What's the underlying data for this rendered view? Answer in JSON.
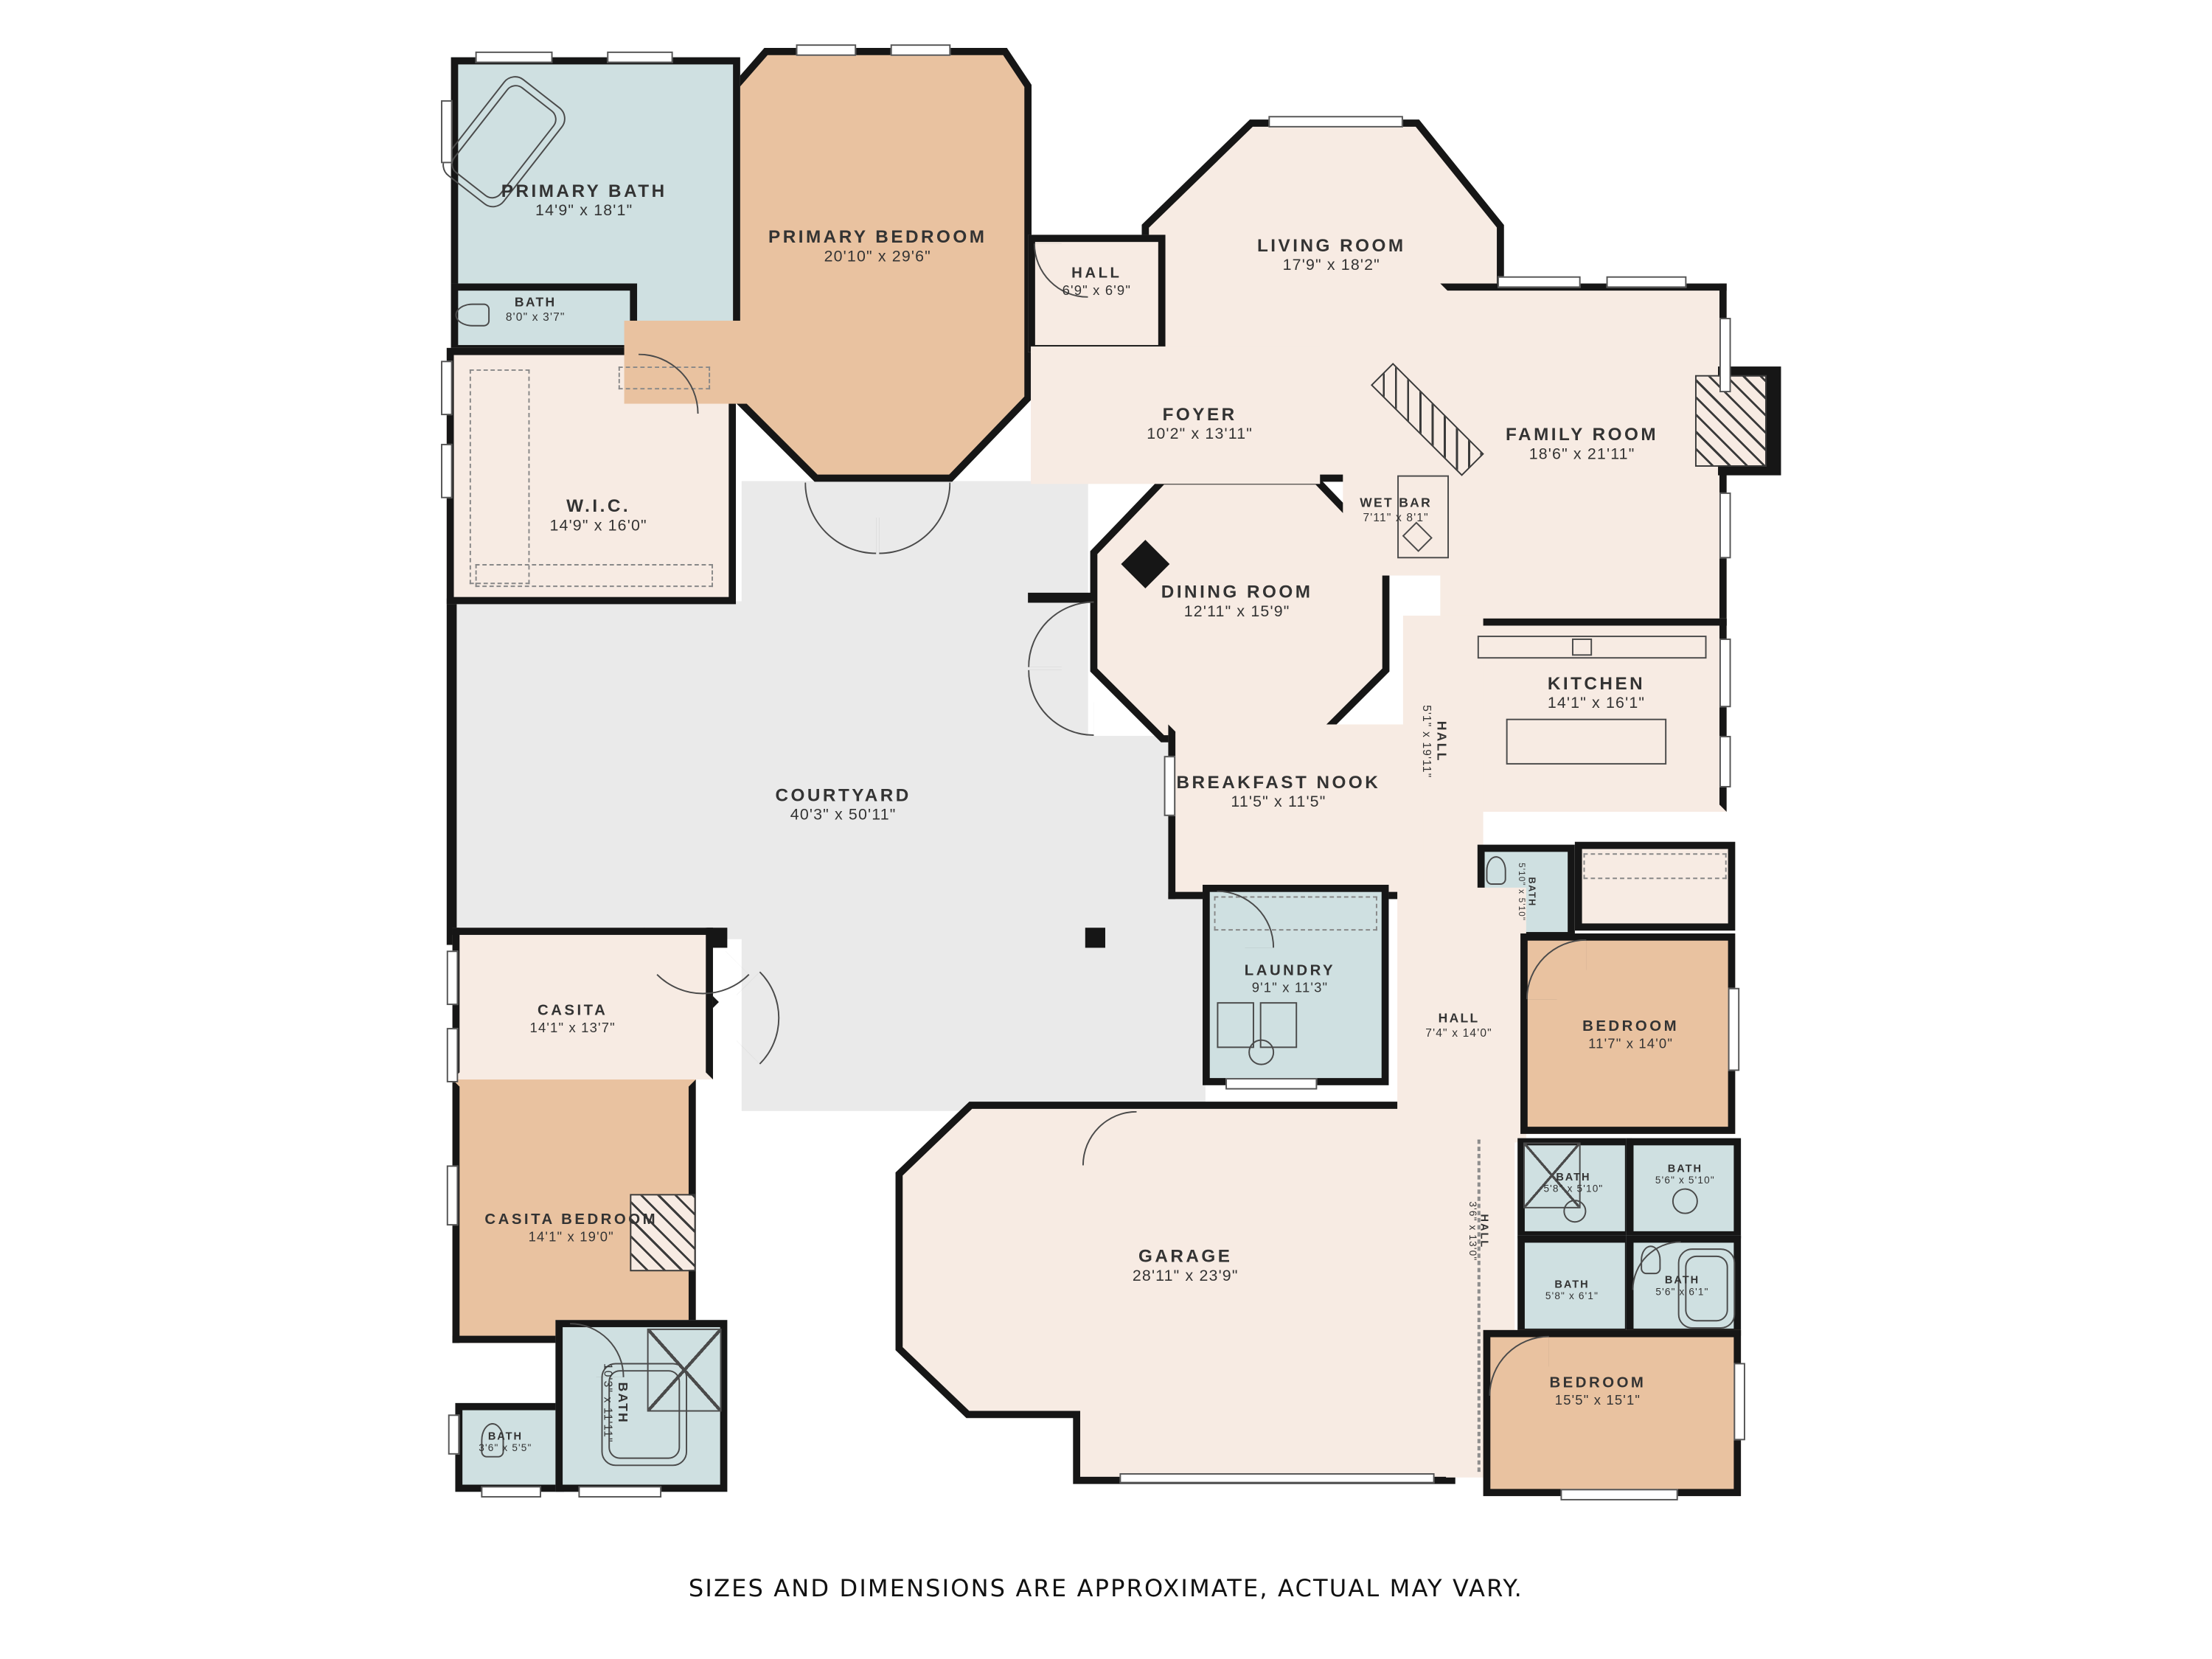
{
  "page": {
    "background": "#ffffff"
  },
  "palette": {
    "wall": "#161616",
    "bedroom_fill": "#e9c2a0",
    "bath_fill": "#cfe0e1",
    "living_fill": "#f7ebe3",
    "courtyard_fill": "#eaeaea",
    "window": "#ffffff",
    "text": "#333333"
  },
  "rooms": [
    {
      "name": "PRIMARY BATH",
      "dims": "14'9\" x 18'1\"",
      "fill": "bath"
    },
    {
      "name": "BATH",
      "dims": "8'0\" x 3'7\"",
      "fill": "bath"
    },
    {
      "name": "W.I.C.",
      "dims": "14'9\" x 16'0\"",
      "fill": "living"
    },
    {
      "name": "PRIMARY BEDROOM",
      "dims": "20'10\" x 29'6\"",
      "fill": "bedroom"
    },
    {
      "name": "HALL",
      "dims": "6'9\" x 6'9\"",
      "fill": "living"
    },
    {
      "name": "LIVING ROOM",
      "dims": "17'9\" x 18'2\"",
      "fill": "living"
    },
    {
      "name": "FOYER",
      "dims": "10'2\" x 13'11\"",
      "fill": "living"
    },
    {
      "name": "FAMILY ROOM",
      "dims": "18'6\" x 21'11\"",
      "fill": "living"
    },
    {
      "name": "WET BAR",
      "dims": "7'11\" x 8'1\"",
      "fill": "living"
    },
    {
      "name": "DINING ROOM",
      "dims": "12'11\" x 15'9\"",
      "fill": "living"
    },
    {
      "name": "KITCHEN",
      "dims": "14'1\" x 16'1\"",
      "fill": "living"
    },
    {
      "name": "HALL",
      "dims": "5'1\" x 19'11\"",
      "fill": "living",
      "orientation": "vertical"
    },
    {
      "name": "BREAKFAST NOOK",
      "dims": "11'5\" x 11'5\"",
      "fill": "living"
    },
    {
      "name": "COURTYARD",
      "dims": "40'3\" x 50'11\"",
      "fill": "courtyard"
    },
    {
      "name": "LAUNDRY",
      "dims": "9'1\" x 11'3\"",
      "fill": "bath"
    },
    {
      "name": "BATH",
      "dims": "5'10\" x 5'10\"",
      "fill": "bath",
      "orientation": "vertical"
    },
    {
      "name": "HALL",
      "dims": "7'4\" x 14'0\"",
      "fill": "living"
    },
    {
      "name": "BEDROOM",
      "dims": "11'7\" x 14'0\"",
      "fill": "bedroom"
    },
    {
      "name": "CASITA",
      "dims": "14'1\" x 13'7\"",
      "fill": "living"
    },
    {
      "name": "CASITA BEDROOM",
      "dims": "14'1\" x 19'0\"",
      "fill": "bedroom"
    },
    {
      "name": "BATH",
      "dims": "3'6\" x 5'5\"",
      "fill": "bath"
    },
    {
      "name": "BATH",
      "dims": "10'3\" x 11'11\"",
      "fill": "bath",
      "orientation": "vertical"
    },
    {
      "name": "GARAGE",
      "dims": "28'11\" x 23'9\"",
      "fill": "living"
    },
    {
      "name": "HALL",
      "dims": "3'6\" x 13'0\"",
      "fill": "living",
      "orientation": "vertical"
    },
    {
      "name": "BATH",
      "dims": "5'8\" x 5'10\"",
      "fill": "bath"
    },
    {
      "name": "BATH",
      "dims": "5'6\" x 5'10\"",
      "fill": "bath"
    },
    {
      "name": "BATH",
      "dims": "5'8\" x 6'1\"",
      "fill": "bath"
    },
    {
      "name": "BATH",
      "dims": "5'6\" x 6'1\"",
      "fill": "bath"
    },
    {
      "name": "BEDROOM",
      "dims": "15'5\" x 15'1\"",
      "fill": "bedroom"
    }
  ],
  "footer": {
    "note": "SIZES AND DIMENSIONS ARE APPROXIMATE, ACTUAL MAY VARY."
  }
}
